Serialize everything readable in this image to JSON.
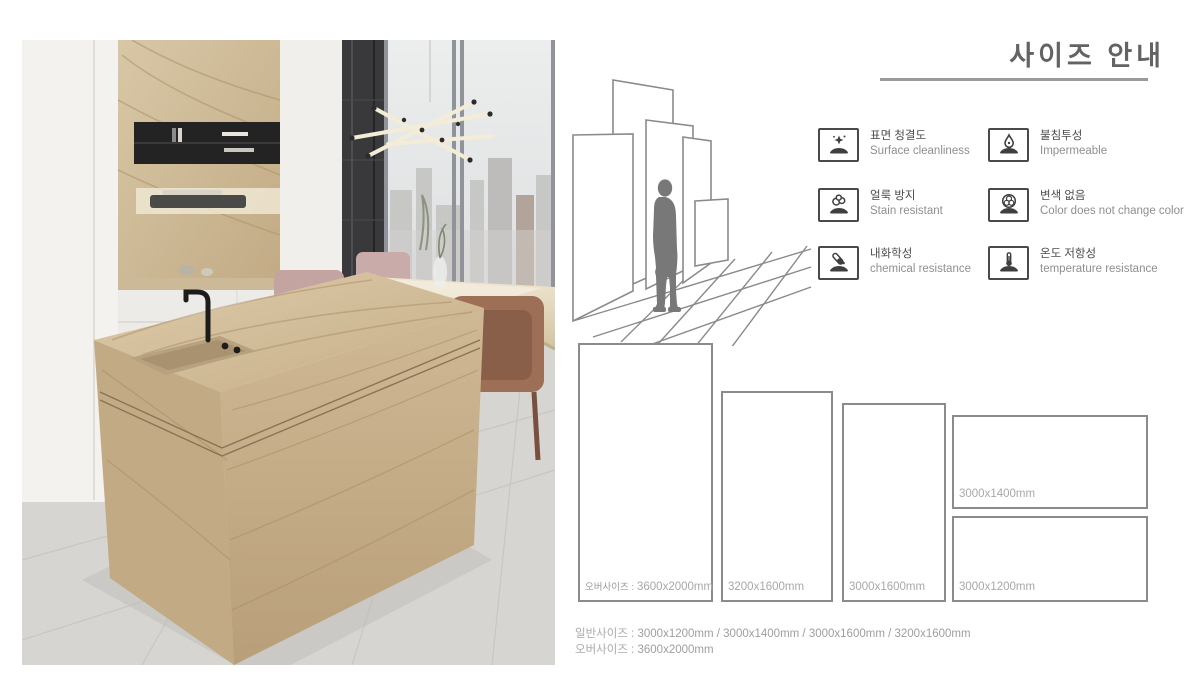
{
  "page": {
    "title": "사이즈 안내"
  },
  "features": [
    {
      "ko": "표면 청결도",
      "en": "Surface cleanliness",
      "icon": "sparkle-surface"
    },
    {
      "ko": "불침투성",
      "en": "Impermeable",
      "icon": "water-drop"
    },
    {
      "ko": "얼룩 방지",
      "en": "Stain resistant",
      "icon": "stain-blobs"
    },
    {
      "ko": "변색 없음",
      "en": "Color does not change color",
      "icon": "color-circles"
    },
    {
      "ko": "내화학성",
      "en": "chemical resistance",
      "icon": "chemical-tube"
    },
    {
      "ko": "온도 저항성",
      "en": "temperature resistance",
      "icon": "thermometer"
    }
  ],
  "size_chart": {
    "slabs": [
      {
        "prefix": "오버사이즈 :",
        "size": "3600x2000mm"
      },
      {
        "size": "3200x1600mm"
      },
      {
        "size": "3000x1600mm"
      },
      {
        "size": "3000x1400mm"
      },
      {
        "size": "3000x1200mm"
      }
    ]
  },
  "summary": {
    "general_label": "일반사이즈 :",
    "general_sizes": "3000x1200mm / 3000x1400mm / 3000x1600mm / 3200x1600mm",
    "oversize_label": "오버사이즈 :",
    "oversize_size": "3600x2000mm"
  },
  "colors": {
    "title": "#636363",
    "rule": "#9a9a9a",
    "outline": "#8b8b8b",
    "size_label": "#a8a8a8",
    "icon_ink": "#3f3f3f",
    "marble": "#cdb592"
  }
}
